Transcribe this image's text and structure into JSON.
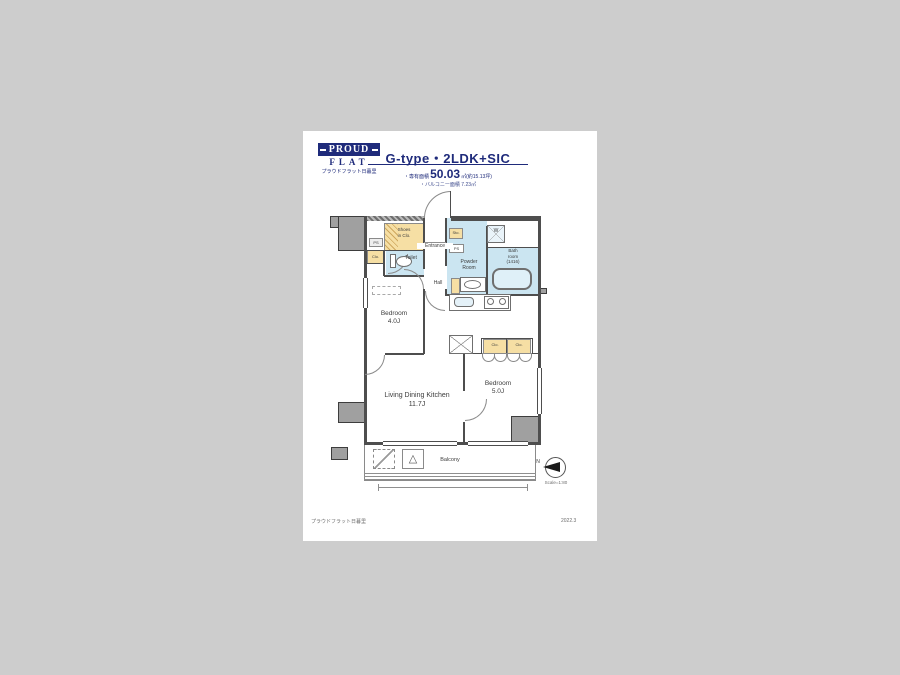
{
  "surface": {
    "canvas_bg": "#cdcdcd",
    "sheet_bg": "#ffffff"
  },
  "logo": {
    "brand": "PROUD",
    "brand2": "FLAT",
    "caption": "プラウドフラット日暮里"
  },
  "header": {
    "title": "G-type・2LDK+SIC",
    "area_label": "・専有面積",
    "area_value": "50.03",
    "area_unit": "㎡(約15.13坪)",
    "balcony_area": "・バルコニー面積 7.23㎡"
  },
  "plan": {
    "shoes_clo_1": "Shoes",
    "shoes_clo_2": "in Clo.",
    "entrance": "Entrance",
    "toilet": "Toilet",
    "powder_1": "Powder",
    "powder_2": "Room",
    "bath_1": "Bath",
    "bath_2": "room",
    "bath_3": "(1416)",
    "hall": "Hall",
    "bedroom1_name": "Bedroom",
    "bedroom1_size": "4.0J",
    "ldk_name": "Living Dining Kitchen",
    "ldk_size": "11.7J",
    "bedroom2_name": "Bedroom",
    "bedroom2_size": "5.0J",
    "balcony": "Balcony",
    "sto": "Sto.",
    "clo": "Clo.",
    "ps": "PS",
    "washer": "W"
  },
  "compass": {
    "north": "N",
    "scale": "Scale=1:80"
  },
  "footer": {
    "left": "プラウドフラット日暮里",
    "right": "2022.3"
  },
  "colors": {
    "navy": "#1f2b7b",
    "tan": "#f6dfa4",
    "water_blue": "#cbe5f1",
    "wall_gray": "#a0a0a0"
  }
}
